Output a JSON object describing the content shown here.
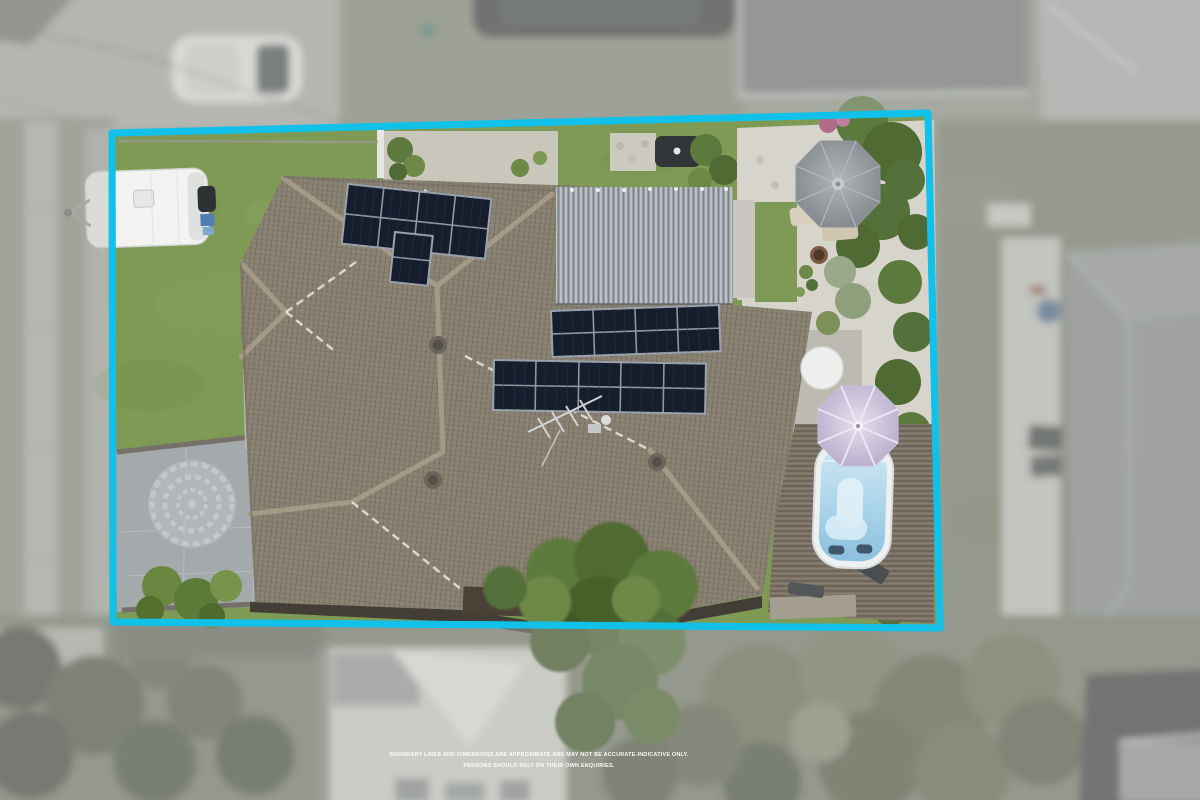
{
  "image": {
    "description": "Overhead drone photograph of a single-storey home with grey tiled hip roof, rooftop solar panels, corrugated metal garage roof, swim spa with deck, two patio umbrellas, white caravan on the lawn and a stamped-concrete driveway, outlined with a cyan property boundary; surroundings are blurred and desaturated",
    "width_px": 1200,
    "height_px": 800
  },
  "boundary": {
    "color": "#12c1e9",
    "corners": "112,133 928,113 940,628 113,622",
    "stroke_width": 7
  },
  "disclaimer": {
    "line1": "BOUNDARY LINES AND DIMENSIONS ARE APPROXIMATE AND MAY NOT BE ACCURATE-INDICATIVE ONLY.",
    "line2": "PERSONS SHOULD RELY ON THEIR OWN ENQUIRIES.",
    "color": "#ffffff"
  },
  "palette": {
    "lawn": "#7e9a55",
    "roof_tiles": "#8b8374",
    "garage_metal": "#9ba1a6",
    "driveway_concrete": "#a4a9ab",
    "gravel": "#d7d5cb",
    "deck_timber": "#7d7467",
    "pool_water": "#a9d3ea",
    "solar_panel": "#161d2c",
    "umbrella_grey": "#8f9498",
    "umbrella_lilac": "#c9bfda",
    "outside_wash": "#b8bab2"
  },
  "features": {
    "solar_arrays": [
      {
        "location": "front roof",
        "panels": 8
      },
      {
        "location": "front roof lower",
        "panels": 2
      },
      {
        "location": "rear roof upper",
        "panels": 8
      },
      {
        "location": "rear roof lower",
        "panels": 10
      }
    ],
    "objects": [
      "white caravan",
      "swim spa",
      "grey patio umbrella",
      "lilac pool umbrella",
      "fire pit",
      "tv antenna",
      "circular paver motif on driveway",
      "corrugated garage roof",
      "timber pool deck",
      "white car parked on street"
    ]
  }
}
